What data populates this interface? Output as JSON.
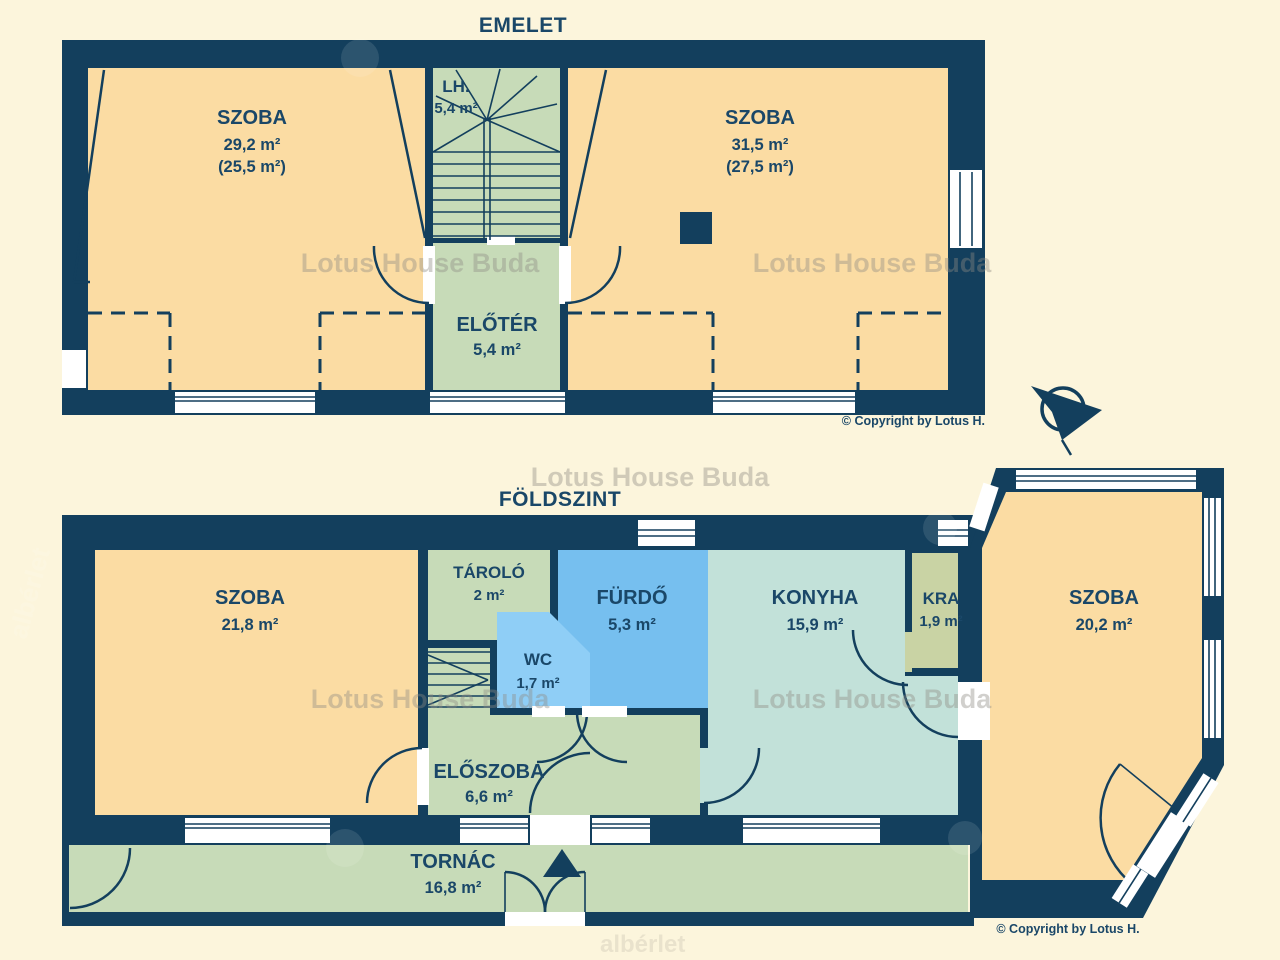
{
  "colors": {
    "wall": "#133F5D",
    "ink": "#1A4768",
    "peach": "#FBDCA3",
    "green": "#C7DBB8",
    "teal": "#C2E1D9",
    "blue": "#76BFEF",
    "blue2": "#8FCEF6",
    "sage": "#C9D3A4",
    "cream": "#FCF5DC",
    "wm": "#8F8C84"
  },
  "watermark": {
    "text": "Lotus House Buda",
    "brand": "albérlet"
  },
  "upper": {
    "title": "EMELET",
    "copyright": "© Copyright by Lotus H.",
    "rooms": {
      "szoba_left": {
        "name": "SZOBA",
        "area": "29,2 m²",
        "area_net": "(25,5 m²)"
      },
      "lh": {
        "name": "LH.",
        "area": "5,4 m²"
      },
      "eloter": {
        "name": "ELŐTÉR",
        "area": "5,4 m²"
      },
      "szoba_right": {
        "name": "SZOBA",
        "area": "31,5 m²",
        "area_net": "(27,5 m²)"
      }
    }
  },
  "ground": {
    "title": "FÖLDSZINT",
    "copyright": "© Copyright by Lotus H.",
    "rooms": {
      "szoba_left": {
        "name": "SZOBA",
        "area": "21,8 m²"
      },
      "tarolo": {
        "name": "TÁROLÓ",
        "area": "2 m²"
      },
      "furdo": {
        "name": "FÜRDŐ",
        "area": "5,3 m²"
      },
      "wc": {
        "name": "WC",
        "area": "1,7 m²"
      },
      "eloszoba": {
        "name": "ELŐSZOBA",
        "area": "6,6 m²"
      },
      "konyha": {
        "name": "KONYHA",
        "area": "15,9 m²"
      },
      "kra": {
        "name": "KRA",
        "area": "1,9 m²"
      },
      "szoba_right": {
        "name": "SZOBA",
        "area": "20,2 m²"
      },
      "tornac": {
        "name": "TORNÁC",
        "area": "16,8 m²"
      }
    }
  }
}
